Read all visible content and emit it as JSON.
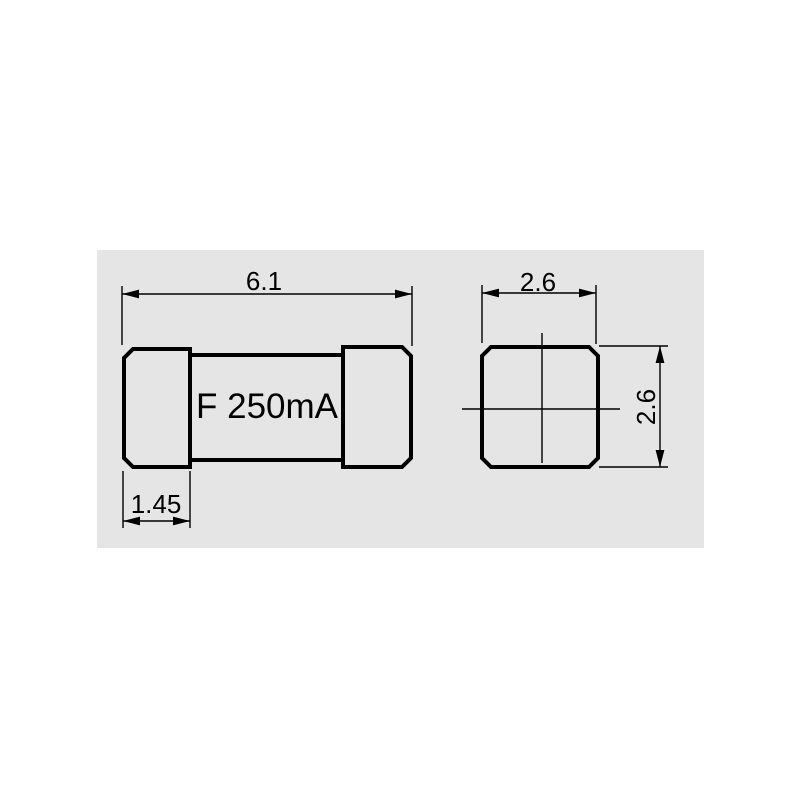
{
  "colors": {
    "page_bg": "#ffffff",
    "panel_bg": "#e5e5e5",
    "line": "#000000",
    "text": "#000000"
  },
  "panel": {
    "description": "technical-drawing-panel"
  },
  "fuse_side_view": {
    "marking": "F 250mA",
    "length_dim": "6.1",
    "cap_dim": "1.45"
  },
  "fuse_end_view": {
    "width_dim": "2.6",
    "height_dim": "2.6"
  }
}
